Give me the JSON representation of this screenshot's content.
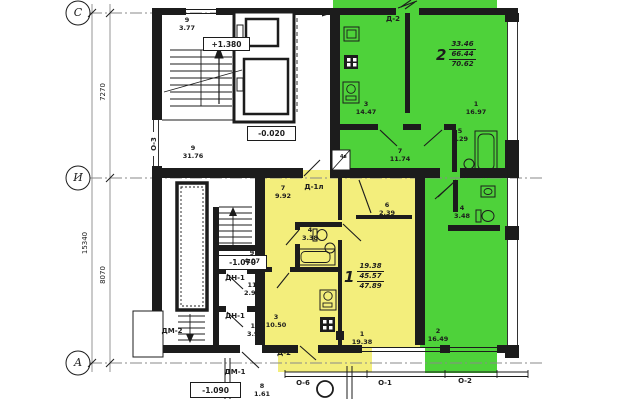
{
  "plan": {
    "grid_rows": {
      "c": "С",
      "i": "И",
      "a": "А"
    },
    "dimensions": {
      "total": "15340",
      "upper": "7270",
      "lower": "8070"
    },
    "elevations": {
      "mid_landing": "+1.380",
      "ground": "-0.020",
      "lower_landing": "-1.070",
      "entrance": "-1.090"
    },
    "door_marks": {
      "d2_top": "Д-2",
      "d1l": "Д-1л",
      "d2_kitchen": "Д-2",
      "dm2": "ДМ-2",
      "dn1_upper": "ДН-1",
      "dn1_lower": "ДН-1",
      "dm1": "ДМ-1"
    },
    "window_marks": {
      "o3": "О-3",
      "o6": "О-6",
      "o1": "О-1",
      "o2": "О-2"
    },
    "vent_mark": "4в",
    "apartment1": {
      "number": "1",
      "living_area": "19.38",
      "usable_area": "45.57",
      "total_area": "47.89",
      "rooms": {
        "living": {
          "num": "1",
          "area": "19.38"
        },
        "kitchen": {
          "num": "3",
          "area": "10.50"
        },
        "bathroom": {
          "num": "4",
          "area": "3.38"
        },
        "closet": {
          "num": "6",
          "area": "2.39"
        },
        "hall": {
          "num": "7",
          "area": "9.92"
        }
      }
    },
    "apartment2": {
      "number": "2",
      "living_area": "33.46",
      "usable_area": "66.44",
      "total_area": "70.62",
      "rooms": {
        "living": {
          "num": "1",
          "area": "16.97"
        },
        "bedroom": {
          "num": "2",
          "area": "16.49"
        },
        "kitchen": {
          "num": "3",
          "area": "14.47"
        },
        "wc": {
          "num": "4",
          "area": "3.48"
        },
        "bathroom": {
          "num": "5",
          "area": "3.29"
        },
        "hall": {
          "num": "7",
          "area": "11.74"
        }
      }
    },
    "common_areas": {
      "stair_upper": {
        "num": "9",
        "area": "3.77"
      },
      "lobby": {
        "num": "9",
        "area": "31.76"
      },
      "stair_lower": {
        "num": "9",
        "area": "4.07"
      },
      "vestibule_upper": {
        "num": "11",
        "area": "2.94"
      },
      "vestibule_lower": {
        "num": "11",
        "area": "3.91"
      },
      "porch": {
        "num": "8",
        "area": "1.61"
      }
    },
    "colors": {
      "apartment1_fill": "#f3ee7c",
      "apartment2_fill": "#4ed23a",
      "wall": "#1c1c1c"
    }
  }
}
